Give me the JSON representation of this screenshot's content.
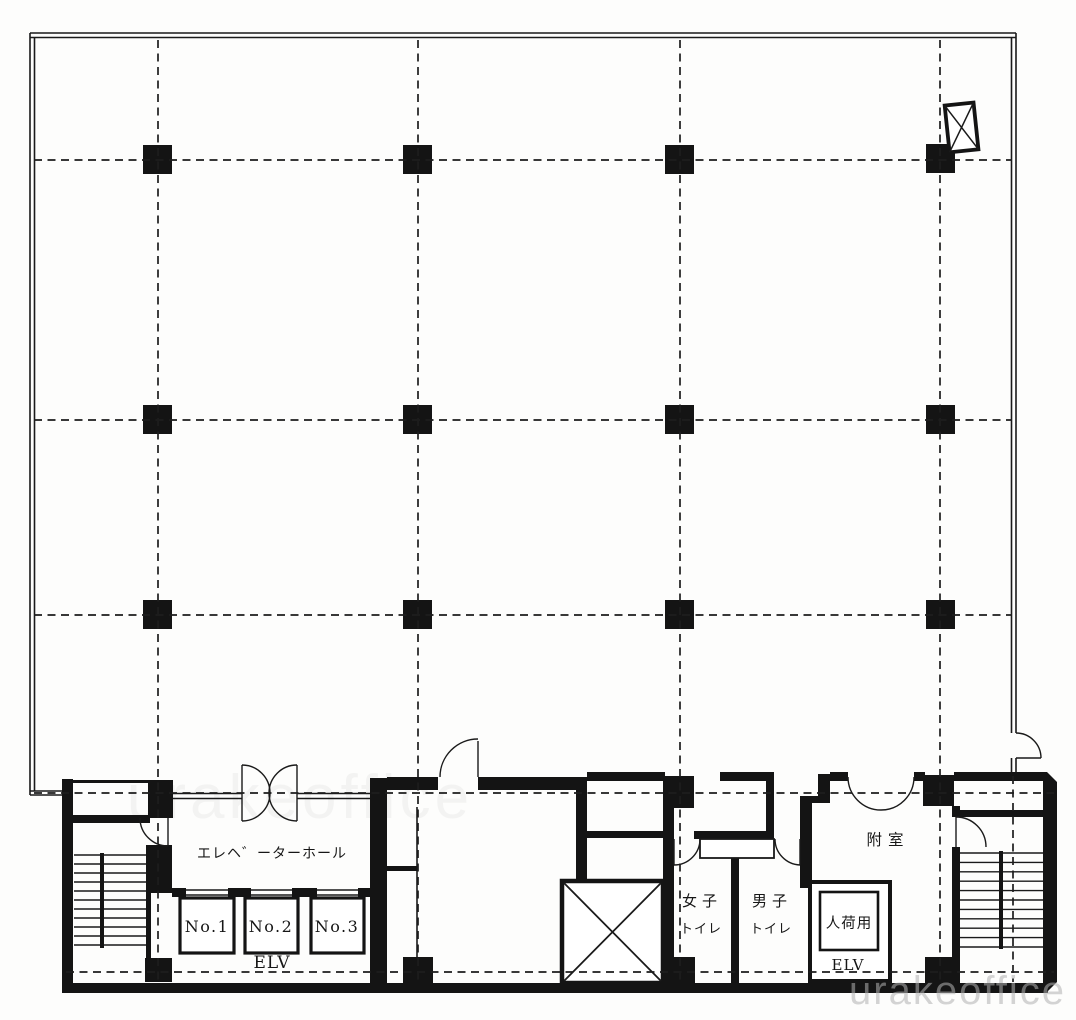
{
  "plan": {
    "rooms": {
      "elevator_hall": "エレヘ゛ーターホール",
      "womens_toilet_line1": "女子",
      "womens_toilet_line2": "トイレ",
      "mens_toilet_line1": "男子",
      "mens_toilet_line2": "トイレ",
      "anteroom": "附室"
    },
    "elevators": {
      "car1": "No.1",
      "car2": "No.2",
      "car3": "No.3",
      "bank_label": "ELV",
      "freight_label": "人荷用",
      "freight_sub_label": "ELV"
    },
    "watermark": "urakeoffice",
    "colors": {
      "ink": "#1a1a1a",
      "paper": "#fdfdfc",
      "watermark": "#b2b2b2"
    }
  }
}
